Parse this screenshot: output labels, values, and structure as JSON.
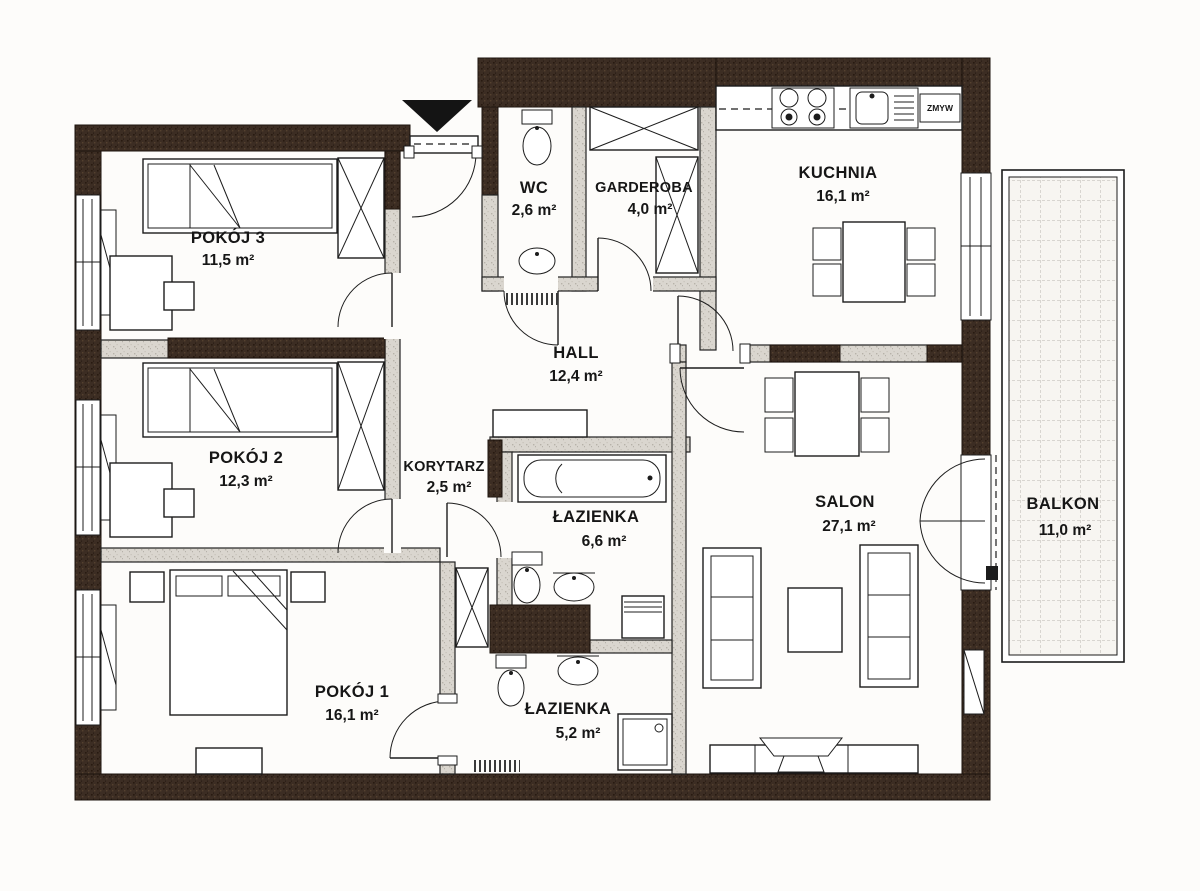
{
  "plan": {
    "rooms": [
      {
        "id": "pokoj3",
        "name": "POKÓJ 3",
        "area": "11,5 m²"
      },
      {
        "id": "pokoj2",
        "name": "POKÓJ 2",
        "area": "12,3 m²"
      },
      {
        "id": "pokoj1",
        "name": "POKÓJ 1",
        "area": "16,1 m²"
      },
      {
        "id": "wc",
        "name": "WC",
        "area": "2,6 m²"
      },
      {
        "id": "garderoba",
        "name": "GARDEROBA",
        "area": "4,0 m²"
      },
      {
        "id": "kuchnia",
        "name": "KUCHNIA",
        "area": "16,1 m²"
      },
      {
        "id": "hall",
        "name": "HALL",
        "area": "12,4 m²"
      },
      {
        "id": "korytarz",
        "name": "KORYTARZ",
        "area": "2,5 m²"
      },
      {
        "id": "lazienka-duza",
        "name": "ŁAZIENKA",
        "area": "6,6 m²"
      },
      {
        "id": "lazienka-mala",
        "name": "ŁAZIENKA",
        "area": "5,2 m²"
      },
      {
        "id": "salon",
        "name": "SALON",
        "area": "27,1 m²"
      },
      {
        "id": "balkon",
        "name": "BALKON",
        "area": "11,0 m²"
      }
    ],
    "labels": {
      "dishwasher": "ZMYW"
    },
    "colors": {
      "wall_dark": "#3c2d23",
      "wall_light": "#dad6cf",
      "line": "#1c1c1c",
      "paper": "#fdfcfa"
    }
  }
}
